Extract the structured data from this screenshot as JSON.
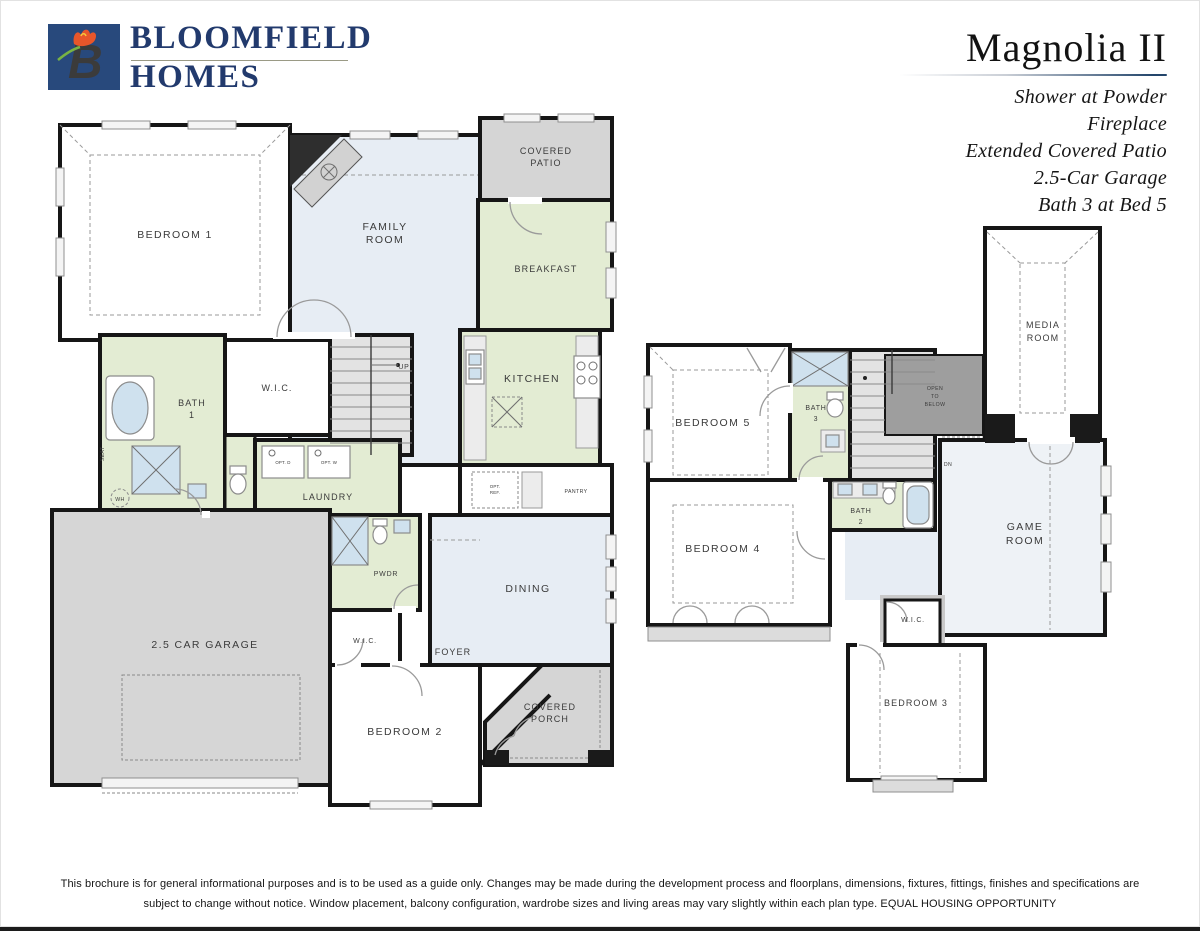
{
  "brand": {
    "name_line1": "BLOOMFIELD",
    "name_line2": "HOMES",
    "logo_letter": "B"
  },
  "header": {
    "plan_name": "Magnolia II",
    "options": [
      "Shower at Powder",
      "Fireplace",
      "Extended Covered Patio",
      "2.5-Car Garage",
      "Bath 3 at Bed 5"
    ]
  },
  "f1": {
    "bedroom1": "BEDROOM 1",
    "family_1": "FAMILY",
    "family_2": "ROOM",
    "patio_1": "COVERED",
    "patio_2": "PATIO",
    "breakfast": "BREAKFAST",
    "kitchen": "KITCHEN",
    "bath1_1": "BATH",
    "bath1_2": "1",
    "wic": "W.I.C.",
    "up": "UP",
    "laundry": "LAUNDRY",
    "opt_d": "OPT. D",
    "opt_w": "OPT. W",
    "pwdr": "PWDR",
    "opt_ref_1": "OPT.",
    "opt_ref_2": "REF.",
    "pantry": "PANTRY",
    "dining": "DINING",
    "foyer": "FOYER",
    "wic2": "W.I.C.",
    "garage": "2.5 CAR GARAGE",
    "bedroom2": "BEDROOM 2",
    "porch_1": "COVERED",
    "porch_2": "PORCH",
    "seat": "SEAT",
    "wh": "WH"
  },
  "f2": {
    "bedroom5": "BEDROOM 5",
    "bath3_1": "BATH",
    "bath3_2": "3",
    "media_1": "MEDIA",
    "media_2": "ROOM",
    "otb_1": "OPEN",
    "otb_2": "TO",
    "otb_3": "BELOW",
    "dn": "DN",
    "bedroom4": "BEDROOM 4",
    "bath2_1": "BATH",
    "bath2_2": "2",
    "game_1": "GAME",
    "game_2": "ROOM",
    "wic": "W.I.C.",
    "bedroom3": "BEDROOM 3"
  },
  "footer": {
    "line1": "This brochure is for general informational purposes and is to be used as a guide only. Changes may be made during the development process and floorplans, dimensions, fixtures, fittings, finishes and specifications are",
    "line2": "subject to change without notice. Window placement, balcony configuration, wardrobe sizes and living areas may vary slightly within each plan type.  EQUAL HOUSING OPPORTUNITY"
  },
  "colors": {
    "wall": "#161616",
    "room_green": "#e3ecd3",
    "room_blue": "#e7edf4",
    "room_pale": "#eef2f6",
    "outdoor_gray": "#d5d5d5",
    "open_below_gray": "#9e9e9e",
    "stair_gray": "#e3e3e3",
    "fixture_blue": "#cfe1ee",
    "brand_navy": "#223a6d",
    "logo_square_navy": "#28497c",
    "logo_green": "#79b344",
    "logo_orange": "#e8562a"
  }
}
